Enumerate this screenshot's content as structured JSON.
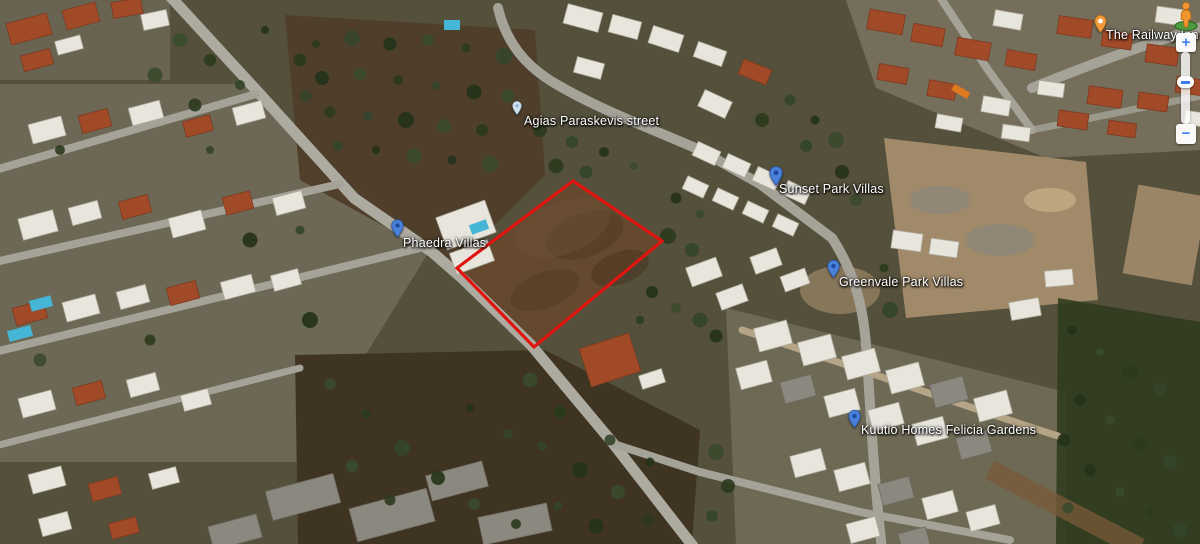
{
  "map": {
    "view": "satellite",
    "labels": [
      {
        "id": "agias-paraskevis-street",
        "text": "Agias Paraskevis street",
        "marker": "street-pin"
      },
      {
        "id": "phaedra-villas",
        "text": "Phaedra Villas",
        "marker": "place-pin"
      },
      {
        "id": "sunset-park-villas",
        "text": "Sunset Park Villas",
        "marker": "place-pin"
      },
      {
        "id": "greenvale-park-villas",
        "text": "Greenvale Park Villas",
        "marker": "place-pin"
      },
      {
        "id": "kuutio-homes-felicia-gardens",
        "text": "Kuutio Homes Felicia Gardens",
        "marker": "place-pin"
      },
      {
        "id": "the-railway-inn",
        "text": "The Railway Inn",
        "marker": "poi-pin"
      }
    ],
    "plot": {
      "points": "573,181 662,241 534,347 457,268",
      "outline_color": "#e11510"
    },
    "controls": {
      "zoom_in_label": "+",
      "zoom_out_label": "−"
    }
  },
  "colors": {
    "plot_outline": "#e11510",
    "place_pin": "#4a80d8",
    "street_pin": "#cfe0ef",
    "poi_pin": "#f29b38",
    "label_text": "#ffffff"
  }
}
